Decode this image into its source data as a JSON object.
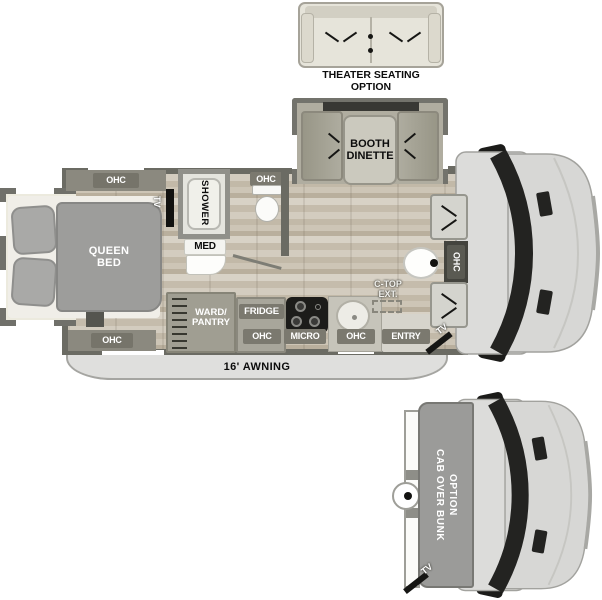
{
  "title": "Class C motorhome floor plan",
  "theater": {
    "line1": "THEATER SEATING",
    "line2": "OPTION"
  },
  "dinette": {
    "line1": "BOOTH",
    "line2": "DINETTE"
  },
  "bed": {
    "ohc_top": "OHC",
    "ohc_bottom": "OHC",
    "tv": "TV",
    "line1": "QUEEN",
    "line2": "BED"
  },
  "bath": {
    "shower": "SHOWER",
    "med": "MED",
    "ohc": "OHC"
  },
  "kitchen": {
    "ward1": "WARD/",
    "ward2": "PANTRY",
    "fridge": "FRIDGE",
    "ohc_fridge": "OHC",
    "micro": "MICRO",
    "ohc_sink": "OHC",
    "ctop1": "C-TOP",
    "ctop2": "EXT.",
    "entry": "ENTRY"
  },
  "cab": {
    "ohc": "OHC",
    "tv": "TV"
  },
  "awning": {
    "label": "16' AWNING"
  },
  "bunk": {
    "line1": "CAB OVER BUNK",
    "line2": "OPTION",
    "tv": "TV"
  },
  "colors": {
    "wall": "#6b6b63",
    "cabinet": "#9f9d91",
    "badge": "#7b796f",
    "floor": "#c9c1b2",
    "cab_body": "#d9d9d7",
    "windshield": "#232321",
    "bed_duvet": "#9d9d9b",
    "awning": "#dfdfdd",
    "stove": "#1c1c1a"
  }
}
